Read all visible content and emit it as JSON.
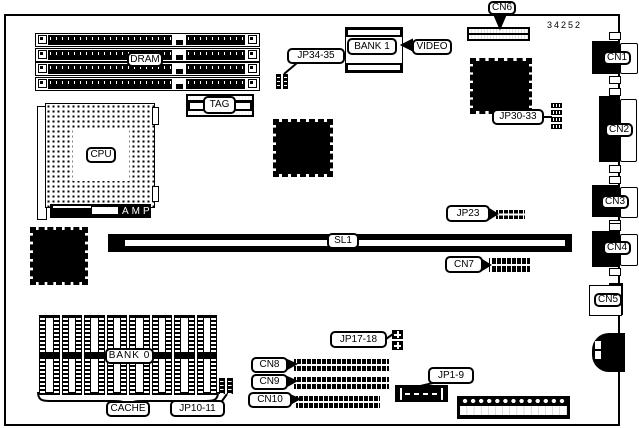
{
  "part_number": "34252",
  "colors": {
    "ink": "#000000",
    "paper": "#ffffff"
  },
  "labels": {
    "dram": "DRAM",
    "cpu": "CPU",
    "amp": "AMP",
    "tag": "TAG",
    "bank1": "BANK 1",
    "video": "VIDEO",
    "cn6": "CN6",
    "jp34_35": "JP34-35",
    "jp30_33": "JP30-33",
    "jp23": "JP23",
    "sl1": "SL1",
    "cn7": "CN7",
    "cn1": "CN1",
    "cn2": "CN2",
    "cn3": "CN3",
    "cn4": "CN4",
    "cn5": "CN5",
    "bank0": "BANK 0",
    "cache": "CACHE",
    "jp10_11": "JP10-11",
    "jp17_18": "JP17-18",
    "cn8": "CN8",
    "cn9": "CN9",
    "cn10": "CN10",
    "jp1_9": "JP1-9"
  }
}
